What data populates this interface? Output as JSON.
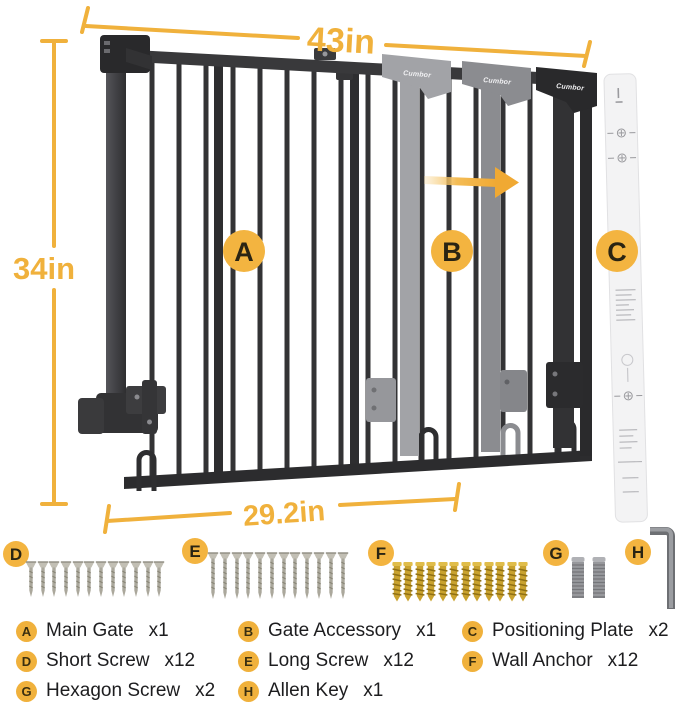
{
  "colors": {
    "accent": "#F0B13C",
    "gate_dark": "#313133",
    "gate_black": "#29292b",
    "ghost_light": "#A2A3A7",
    "ghost_mid": "#8B8C90",
    "anchor_gold": "#C9A22E",
    "plate_fill": "#F3F3F4"
  },
  "diagram": {
    "brand": "Cumbor",
    "width_label": "43in",
    "height_label": "34in",
    "door_width_label": "29.2in",
    "part_labels": {
      "a": "A",
      "b": "B",
      "c": "C"
    }
  },
  "parts_row": {
    "d": "D",
    "e": "E",
    "f": "F",
    "g": "G",
    "h": "H"
  },
  "legend": {
    "items": [
      {
        "key": "A",
        "name": "Main Gate",
        "qty": "x1"
      },
      {
        "key": "B",
        "name": "Gate Accessory",
        "qty": "x1"
      },
      {
        "key": "C",
        "name": "Positioning Plate",
        "qty": "x2"
      },
      {
        "key": "D",
        "name": "Short Screw",
        "qty": "x12"
      },
      {
        "key": "E",
        "name": "Long Screw",
        "qty": "x12"
      },
      {
        "key": "F",
        "name": "Wall Anchor",
        "qty": "x12"
      },
      {
        "key": "G",
        "name": "Hexagon Screw",
        "qty": "x2"
      },
      {
        "key": "H",
        "name": "Allen Key",
        "qty": "x1"
      }
    ]
  }
}
